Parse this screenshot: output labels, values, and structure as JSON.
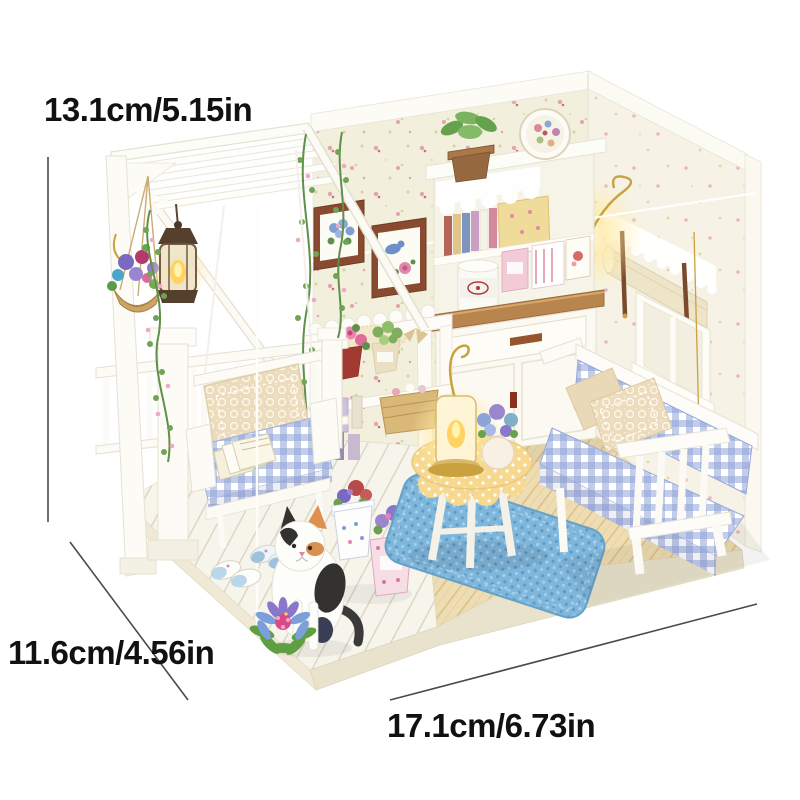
{
  "annotations": {
    "height_label": "13.1cm/5.15in",
    "depth_label": "11.6cm/4.56in",
    "width_label": "17.1cm/6.73in"
  },
  "palette": {
    "background": "#ffffff",
    "label_text": "#111111",
    "dimension_line": "#4a4a4a",
    "wallpaper_cream": "#f2f0dc",
    "gingham_blue": "#8fa3d9",
    "rug_blue": "#7fb6dc",
    "counter_wood": "#b9854e",
    "floor_wood": "#eedcb2",
    "deck_white": "#f6f4eb",
    "tablecloth_yellow": "#f6d88e",
    "lamp_glow": "#ffe9a0",
    "frame_brown": "#8a4a30",
    "vine_green": "#5f8f4a",
    "blossom_pink": "#f0a8c4"
  }
}
